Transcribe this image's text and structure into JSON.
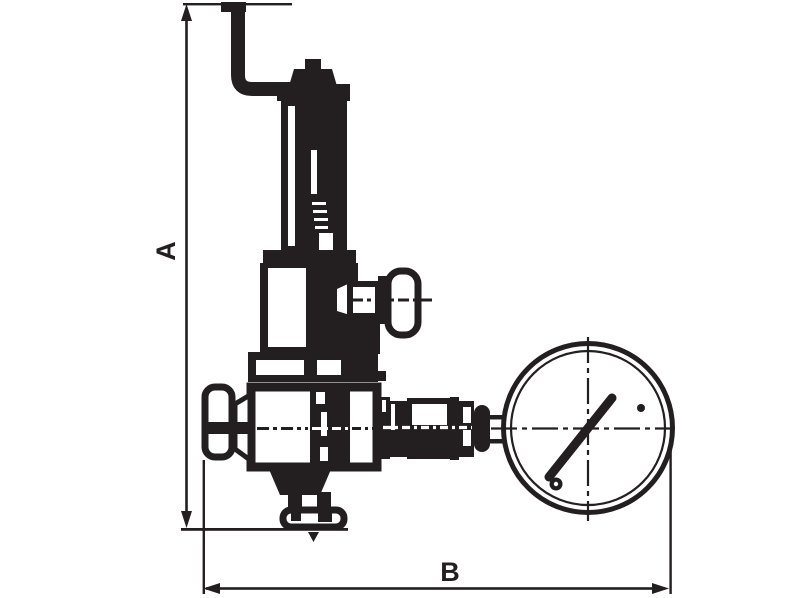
{
  "figure": {
    "type": "technical-drawing",
    "subject": "pressure reducing valve with pressure gauge, dimensioned outline drawing",
    "background_color": "#ffffff",
    "ink_color": "#231f20",
    "dimensions": {
      "vertical": {
        "label": "A"
      },
      "horizontal": {
        "label": "B"
      }
    }
  }
}
